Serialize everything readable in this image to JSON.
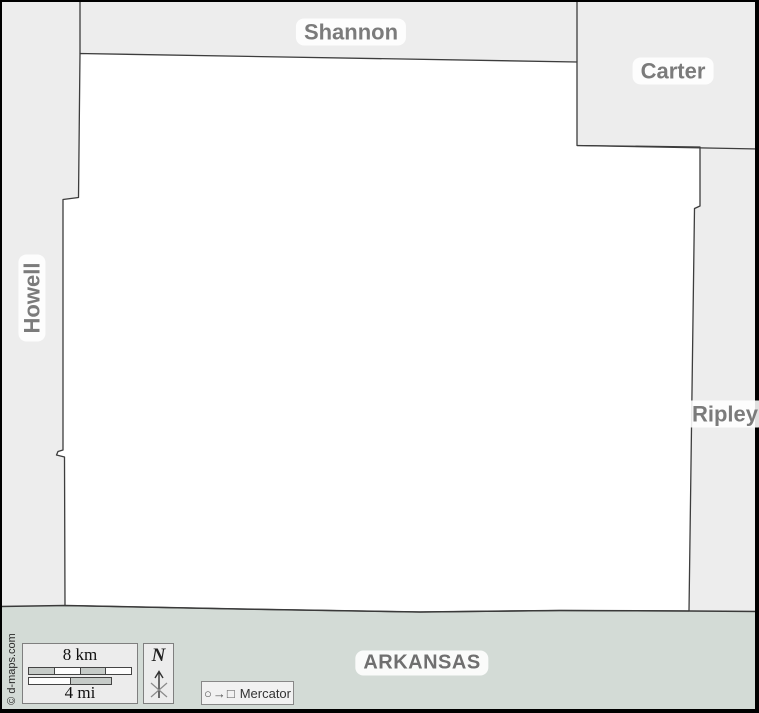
{
  "map": {
    "labels": {
      "shannon": "Shannon",
      "carter": "Carter",
      "howell": "Howell",
      "ripley": "Ripley",
      "arkansas": "ARKANSAS"
    },
    "colors": {
      "main_county_fill": "#ffffff",
      "neighbor_fill": "#ededed",
      "arkansas_fill": "#d3dbd6",
      "boundary_line": "#3d3d3d",
      "county_label_text": "#7b7b7b",
      "state_label_text": "#6f6f6f",
      "frame": "#000000"
    }
  },
  "scale_bar": {
    "km": "8 km",
    "mi": "4 mi"
  },
  "compass": {
    "n": "N"
  },
  "projection": {
    "glyphs": "○→□",
    "name": "Mercator"
  },
  "copyright": "© d-maps.com"
}
